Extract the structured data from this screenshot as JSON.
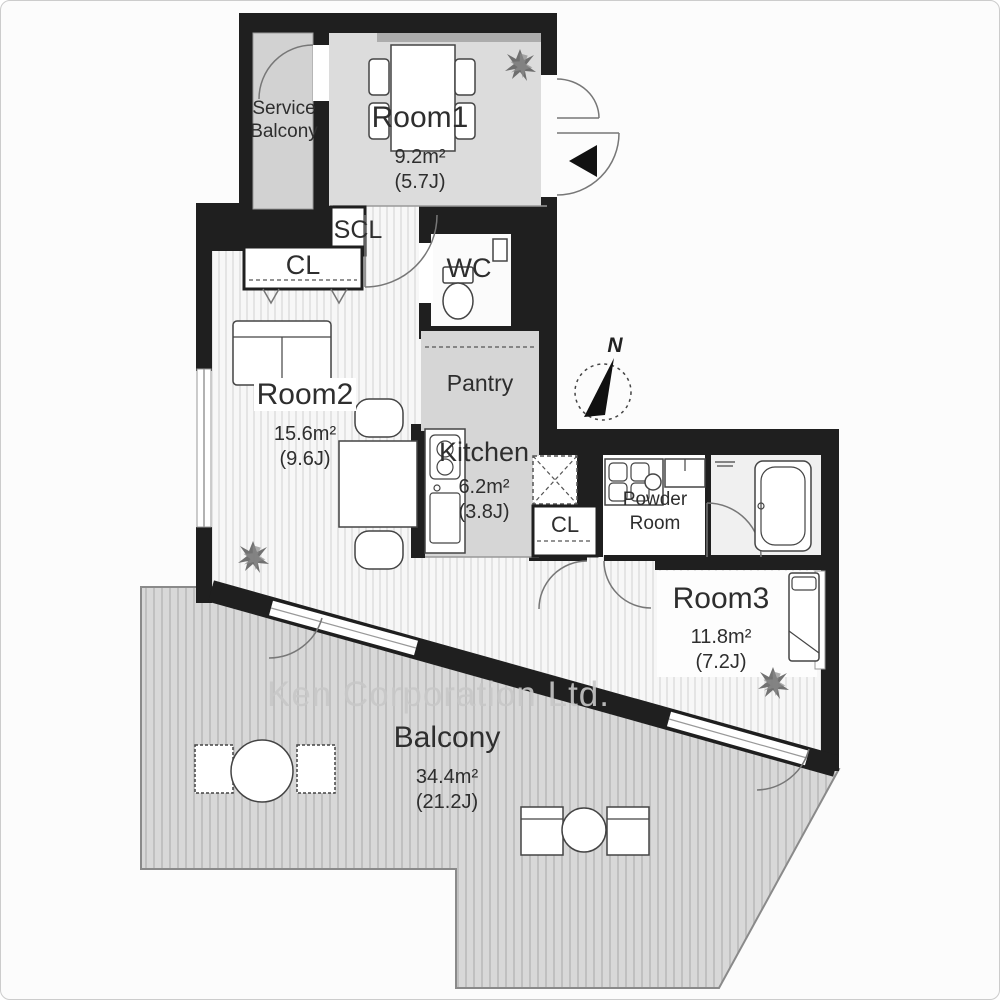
{
  "watermark": {
    "text": "Ken Corporation Ltd."
  },
  "compass": {
    "label": "N"
  },
  "rooms": {
    "service_balcony": {
      "label": "Service Balcony"
    },
    "room1": {
      "label": "Room1",
      "area": "9.2m²",
      "tatami": "(5.7J)"
    },
    "scl": {
      "label": "SCL"
    },
    "closet1": {
      "label": "CL"
    },
    "wc": {
      "label": "WC"
    },
    "pantry": {
      "label": "Pantry"
    },
    "room2": {
      "label": "Room2",
      "area": "15.6m²",
      "tatami": "(9.6J)"
    },
    "kitchen": {
      "label": "Kitchen",
      "area": "6.2m²",
      "tatami": "(3.8J)"
    },
    "closet2": {
      "label": "CL"
    },
    "powder_room": {
      "label": "Powder Room"
    },
    "room3": {
      "label": "Room3",
      "area": "11.8m²",
      "tatami": "(7.2J)"
    },
    "balcony": {
      "label": "Balcony",
      "area": "34.4m²",
      "tatami": "(21.2J)"
    }
  },
  "colors": {
    "wall": "#1f1f1f",
    "floor_gray": "#d6d6d6",
    "room1_floor": "#dcdcdc",
    "stripe_bg": "#f7f7f7",
    "stripe_line": "#d9d9d9",
    "balcony_bg": "#d8d8d8",
    "balcony_line": "#bdbdbd",
    "label": "#2e2e2e",
    "watermark": "#c8c8c8"
  }
}
